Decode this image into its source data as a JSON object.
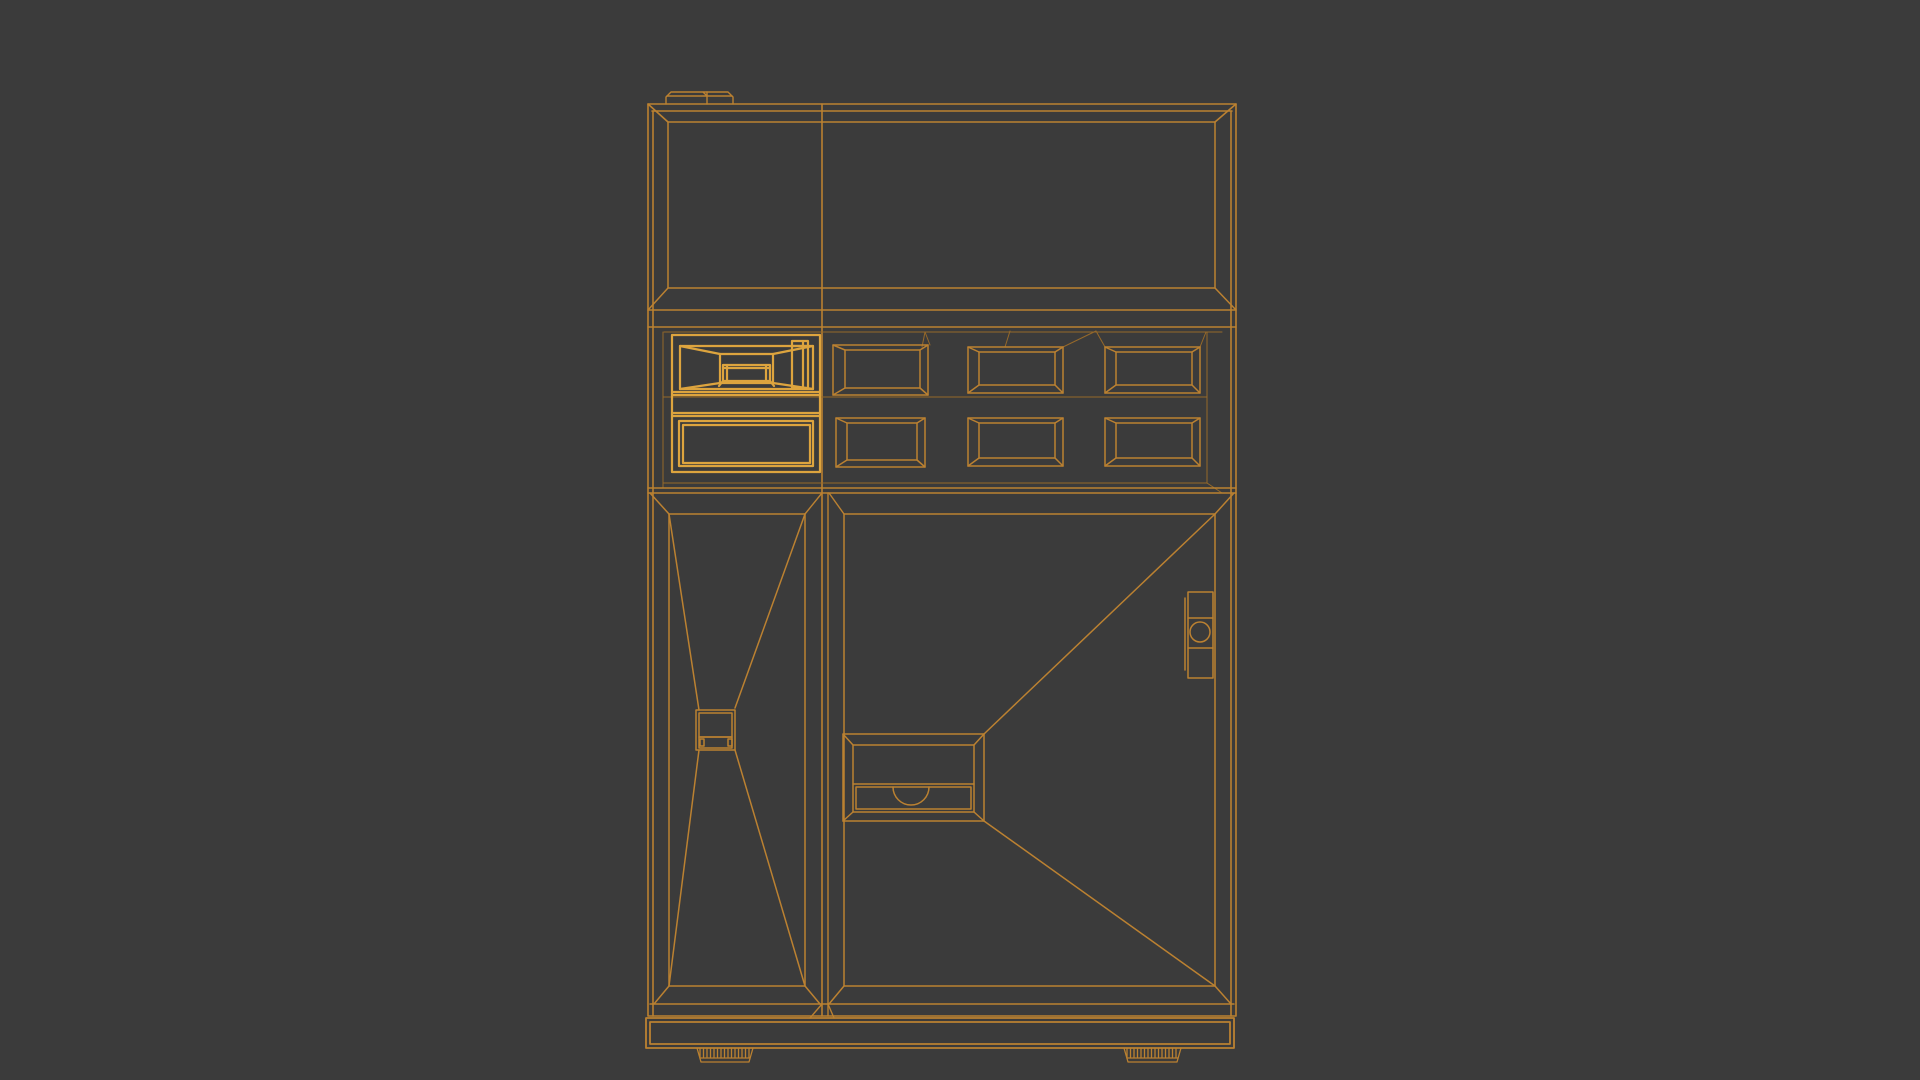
{
  "scene": {
    "object_name": "vending-machine-wireframe",
    "background": "#3b3b3b",
    "canvas": {
      "width": 1920,
      "height": 1080
    },
    "strokes": {
      "main": "#bb8131",
      "bright": "#dda43e",
      "dim": "#96692a"
    }
  },
  "wireframe": {
    "groups": [
      {
        "name": "cabinet-frame",
        "stroke": "main",
        "w": 1.6,
        "el": [
          [
            "r",
            648,
            104,
            588,
            912
          ],
          [
            "l",
            652,
            111,
            1232,
            111
          ],
          [
            "l",
            653,
            111,
            653,
            1016
          ],
          [
            "l",
            1231,
            111,
            1231,
            1016
          ],
          [
            "l",
            648,
            104,
            668,
            122
          ],
          [
            "l",
            1236,
            104,
            1215,
            122
          ],
          [
            "l",
            822,
            104,
            822,
            1016
          ]
        ]
      },
      {
        "name": "roof-cap",
        "stroke": "main",
        "w": 1.4,
        "el": [
          [
            "p",
            "M666 104 L666 97 L671 92 L728 92 L733 97 L733 104"
          ],
          [
            "l",
            667,
            96,
            732,
            96
          ],
          [
            "l",
            707,
            92,
            707,
            104
          ],
          [
            "l",
            703,
            92,
            707,
            96
          ]
        ]
      },
      {
        "name": "display-window",
        "stroke": "main",
        "w": 1.5,
        "el": [
          [
            "r",
            668,
            122,
            547,
            166
          ],
          [
            "l",
            648,
            310,
            668,
            288
          ],
          [
            "l",
            1236,
            310,
            1215,
            288
          ],
          [
            "l",
            648,
            310,
            1236,
            310
          ],
          [
            "l",
            648,
            327,
            1236,
            327
          ]
        ]
      },
      {
        "name": "shelf-recess",
        "stroke": "dim",
        "w": 1,
        "el": [
          [
            "l",
            664,
            332,
            1222,
            332
          ],
          [
            "l",
            663,
            332,
            663,
            488
          ],
          [
            "l",
            1207,
            332,
            1207,
            483
          ],
          [
            "l",
            1207,
            483,
            1222,
            493
          ],
          [
            "l",
            663,
            397,
            1207,
            397
          ],
          [
            "l",
            663,
            483,
            1207,
            483
          ],
          [
            "l",
            922,
            347,
            925,
            332
          ],
          [
            "l",
            925,
            332,
            930,
            345
          ],
          [
            "l",
            1005,
            347,
            1010,
            331
          ],
          [
            "l",
            1063,
            347,
            1096,
            331
          ],
          [
            "l",
            1096,
            331,
            1105,
            347
          ],
          [
            "l",
            1200,
            347,
            1206,
            332
          ]
        ]
      },
      {
        "name": "shelf-row-frame",
        "stroke": "main",
        "w": 1.5,
        "el": [
          [
            "l",
            648,
            488,
            1236,
            488
          ],
          [
            "l",
            648,
            493,
            1236,
            493
          ]
        ]
      },
      {
        "name": "featured-compartment",
        "stroke": "bright",
        "w": 2.2,
        "el": [
          [
            "r",
            672,
            335,
            148,
            137
          ],
          [
            "r",
            680,
            346,
            133,
            43
          ],
          [
            "l",
            680,
            346,
            720,
            354
          ],
          [
            "l",
            813,
            346,
            773,
            354
          ],
          [
            "l",
            680,
            389,
            720,
            383
          ],
          [
            "l",
            813,
            389,
            773,
            383
          ],
          [
            "r",
            720,
            354,
            53,
            29
          ],
          [
            "r",
            723,
            365,
            47,
            16
          ],
          [
            "l",
            723,
            368,
            770,
            368
          ],
          [
            "l",
            727,
            365,
            727,
            381
          ],
          [
            "l",
            766,
            365,
            766,
            381
          ],
          [
            "l",
            723,
            381,
            719,
            386
          ],
          [
            "l",
            770,
            381,
            774,
            386
          ],
          [
            "r",
            792,
            341,
            16,
            47
          ],
          [
            "l",
            803,
            341,
            803,
            388
          ],
          [
            "l",
            792,
            346,
            808,
            346
          ],
          [
            "l",
            672,
            392,
            820,
            392
          ],
          [
            "l",
            672,
            395,
            820,
            395
          ],
          [
            "l",
            672,
            413,
            820,
            413
          ],
          [
            "l",
            672,
            416,
            820,
            416
          ],
          [
            "r",
            679,
            421,
            134,
            45
          ],
          [
            "r",
            683,
            425,
            127,
            38
          ]
        ]
      },
      {
        "name": "product-window-r1c2",
        "stroke": "main",
        "w": 1.5,
        "el": [
          [
            "r",
            833,
            345,
            95,
            50
          ],
          [
            "r",
            845,
            350,
            75,
            38
          ],
          [
            "l",
            833,
            345,
            845,
            350
          ],
          [
            "l",
            928,
            345,
            920,
            350
          ],
          [
            "l",
            833,
            395,
            845,
            388
          ],
          [
            "l",
            928,
            395,
            920,
            388
          ]
        ]
      },
      {
        "name": "product-window-r2c2",
        "stroke": "main",
        "w": 1.5,
        "el": [
          [
            "r",
            836,
            418,
            89,
            49
          ],
          [
            "r",
            847,
            423,
            70,
            37
          ],
          [
            "l",
            836,
            418,
            847,
            423
          ],
          [
            "l",
            925,
            418,
            917,
            423
          ],
          [
            "l",
            836,
            467,
            847,
            460
          ],
          [
            "l",
            925,
            467,
            917,
            460
          ]
        ]
      },
      {
        "name": "product-window-r1c3",
        "stroke": "main",
        "w": 1.5,
        "el": [
          [
            "r",
            968,
            347,
            95,
            46
          ],
          [
            "r",
            979,
            352,
            76,
            33
          ],
          [
            "l",
            968,
            347,
            979,
            352
          ],
          [
            "l",
            1063,
            347,
            1055,
            352
          ],
          [
            "l",
            968,
            393,
            979,
            385
          ],
          [
            "l",
            1063,
            393,
            1055,
            385
          ]
        ]
      },
      {
        "name": "product-window-r2c3",
        "stroke": "main",
        "w": 1.5,
        "el": [
          [
            "r",
            968,
            418,
            95,
            48
          ],
          [
            "r",
            979,
            423,
            76,
            35
          ],
          [
            "l",
            968,
            418,
            979,
            423
          ],
          [
            "l",
            1063,
            418,
            1055,
            423
          ],
          [
            "l",
            968,
            466,
            979,
            458
          ],
          [
            "l",
            1063,
            466,
            1055,
            458
          ]
        ]
      },
      {
        "name": "product-window-r1c4",
        "stroke": "main",
        "w": 1.5,
        "el": [
          [
            "r",
            1105,
            347,
            95,
            46
          ],
          [
            "r",
            1116,
            352,
            76,
            33
          ],
          [
            "l",
            1105,
            347,
            1116,
            352
          ],
          [
            "l",
            1200,
            347,
            1192,
            352
          ],
          [
            "l",
            1105,
            393,
            1116,
            385
          ],
          [
            "l",
            1200,
            393,
            1192,
            385
          ]
        ]
      },
      {
        "name": "product-window-r2c4",
        "stroke": "main",
        "w": 1.5,
        "el": [
          [
            "r",
            1105,
            418,
            95,
            48
          ],
          [
            "r",
            1116,
            423,
            76,
            35
          ],
          [
            "l",
            1105,
            418,
            1116,
            423
          ],
          [
            "l",
            1200,
            418,
            1192,
            423
          ],
          [
            "l",
            1105,
            466,
            1116,
            458
          ],
          [
            "l",
            1200,
            466,
            1192,
            458
          ]
        ]
      },
      {
        "name": "door-gap",
        "stroke": "main",
        "w": 1.4,
        "el": [
          [
            "l",
            828,
            493,
            828,
            1016
          ],
          [
            "l",
            822,
            493,
            805,
            514
          ],
          [
            "l",
            829,
            493,
            844,
            514
          ],
          [
            "l",
            810,
            1018,
            822,
            1004
          ],
          [
            "l",
            834,
            1018,
            828,
            1004
          ]
        ]
      },
      {
        "name": "left-door",
        "stroke": "main",
        "w": 1.5,
        "el": [
          [
            "r",
            669,
            514,
            136,
            472
          ],
          [
            "l",
            650,
            493,
            669,
            514
          ],
          [
            "l",
            654,
            1004,
            669,
            986
          ],
          [
            "l",
            820,
            1004,
            805,
            986
          ],
          [
            "l",
            669,
            514,
            699,
            710
          ],
          [
            "l",
            805,
            514,
            735,
            708
          ],
          [
            "l",
            699,
            750,
            669,
            986
          ],
          [
            "l",
            735,
            750,
            805,
            986
          ]
        ]
      },
      {
        "name": "coin-return-box",
        "stroke": "main",
        "w": 1.5,
        "el": [
          [
            "r",
            696,
            710,
            39,
            40
          ],
          [
            "r",
            699,
            713,
            33,
            24
          ],
          [
            "r",
            699,
            737,
            33,
            11
          ],
          [
            "r",
            700,
            739,
            4,
            7
          ],
          [
            "r",
            728,
            739,
            4,
            7
          ]
        ]
      },
      {
        "name": "right-door",
        "stroke": "main",
        "w": 1.5,
        "el": [
          [
            "r",
            844,
            514,
            371,
            472
          ],
          [
            "l",
            1234,
            493,
            1215,
            514
          ],
          [
            "l",
            829,
            1004,
            844,
            986
          ],
          [
            "l",
            1231,
            1004,
            1215,
            986
          ],
          [
            "l",
            1215,
            514,
            984,
            734
          ],
          [
            "l",
            984,
            821,
            1215,
            986
          ]
        ]
      },
      {
        "name": "dispense-tray",
        "stroke": "main",
        "w": 1.5,
        "el": [
          [
            "r",
            843,
            734,
            141,
            87
          ],
          [
            "l",
            843,
            734,
            853,
            745
          ],
          [
            "l",
            984,
            734,
            974,
            745
          ],
          [
            "l",
            843,
            821,
            853,
            812
          ],
          [
            "l",
            984,
            821,
            974,
            812
          ],
          [
            "r",
            853,
            745,
            121,
            67
          ],
          [
            "l",
            853,
            784,
            974,
            784
          ],
          [
            "r",
            856,
            787,
            115,
            22
          ],
          [
            "p",
            "M893 787 A18 18 0 0 0 929 787"
          ]
        ]
      },
      {
        "name": "door-handle-lock",
        "stroke": "main",
        "w": 1.5,
        "el": [
          [
            "r",
            1188,
            592,
            25,
            86
          ],
          [
            "l",
            1188,
            618,
            1213,
            618
          ],
          [
            "l",
            1188,
            648,
            1213,
            648
          ],
          [
            "c",
            1200,
            632,
            10
          ],
          [
            "l",
            1185,
            598,
            1185,
            670
          ]
        ]
      },
      {
        "name": "door-bottom-edge",
        "stroke": "main",
        "w": 1.5,
        "el": [
          [
            "l",
            650,
            1004,
            1234,
            1004
          ]
        ]
      },
      {
        "name": "base-plinth",
        "stroke": "main",
        "w": 1.8,
        "el": [
          [
            "r",
            646,
            1018,
            588,
            30
          ],
          [
            "r",
            650,
            1022,
            580,
            22
          ]
        ]
      },
      {
        "name": "left-foot",
        "stroke": "main",
        "w": 1.3,
        "el": [
          [
            "p",
            "M697 1048 L701 1062 L749 1062 L753 1048"
          ],
          [
            "l",
            700,
            1058,
            750,
            1058
          ],
          [
            "h",
            700,
            750,
            1048,
            1057,
            3.5
          ]
        ]
      },
      {
        "name": "right-foot",
        "stroke": "main",
        "w": 1.3,
        "el": [
          [
            "p",
            "M1124 1048 L1128 1062 L1177 1062 L1181 1048"
          ],
          [
            "l",
            1127,
            1058,
            1178,
            1058
          ],
          [
            "h",
            1127,
            1178,
            1048,
            1057,
            3.5
          ]
        ]
      }
    ]
  }
}
